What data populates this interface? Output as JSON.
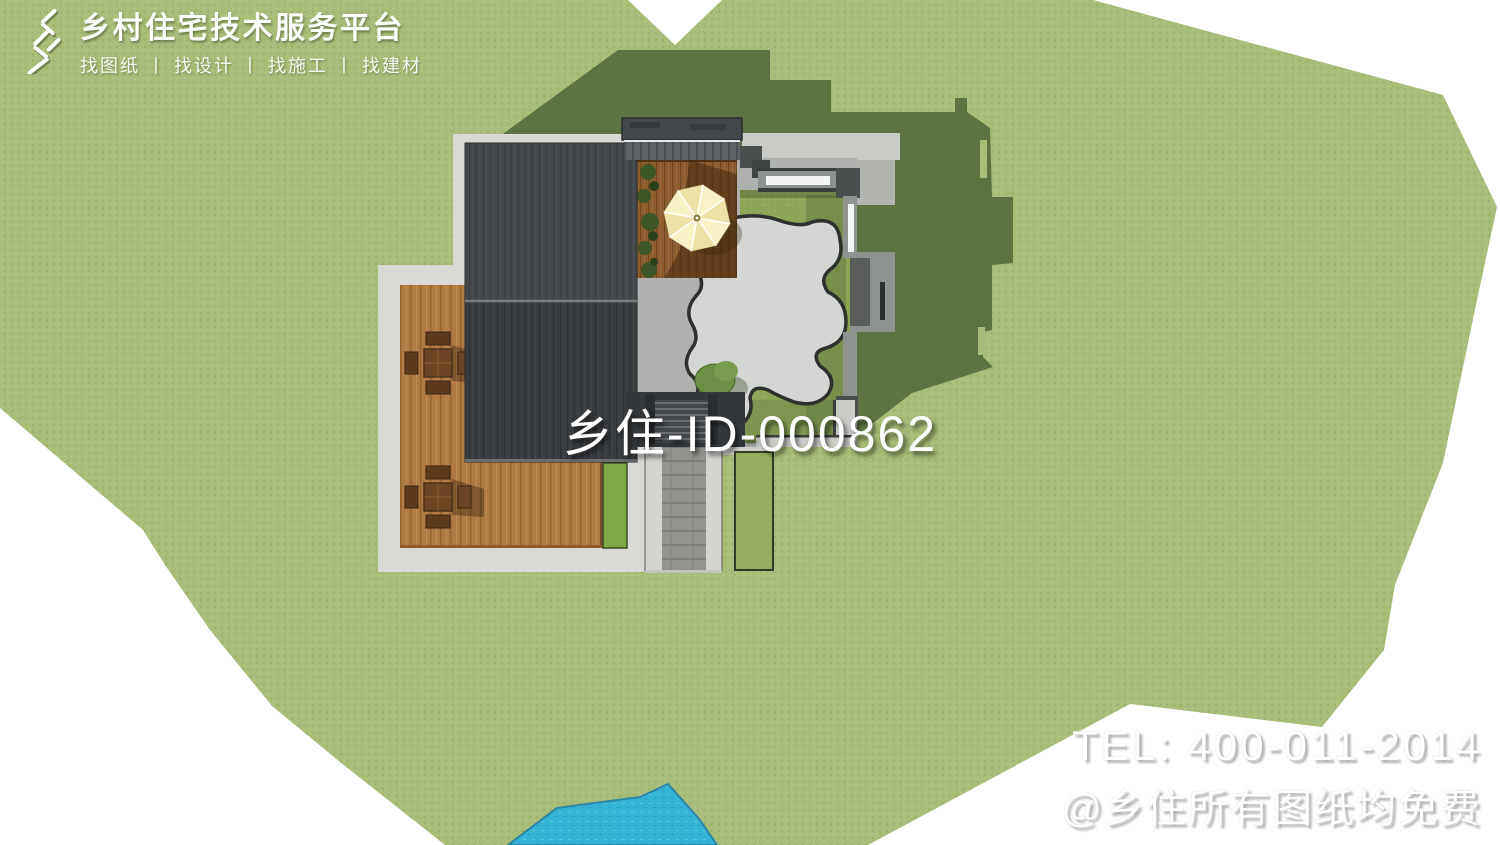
{
  "brand": {
    "icon": "xiang-logo-icon",
    "title": "乡村住宅技术服务平台",
    "subtitle": "找图纸 丨 找设计 丨 找施工 丨 找建材"
  },
  "watermark": {
    "id_text": "乡住-ID-000862"
  },
  "contact": {
    "tel": "TEL: 400-011-2014",
    "note": "@乡住所有图纸均免费"
  },
  "palette": {
    "lawn_green": "#a8bd79",
    "shadow_green": "#5d7343",
    "courtyard_grass": "#8ca557",
    "roof_dark": "#3f4245",
    "walkway_gray": "#d9dad6",
    "rock_paving": "#d4d6d3",
    "deck_wood": "#b07b42",
    "umbrella_deck_wood": "#8a5c2e",
    "umbrella_cream": "#f8f1c6",
    "pond_blue": "#35b3d7",
    "wall_gray": "#8f9390",
    "window_white": "#f4f6f3",
    "text_white": "#ffffff"
  }
}
